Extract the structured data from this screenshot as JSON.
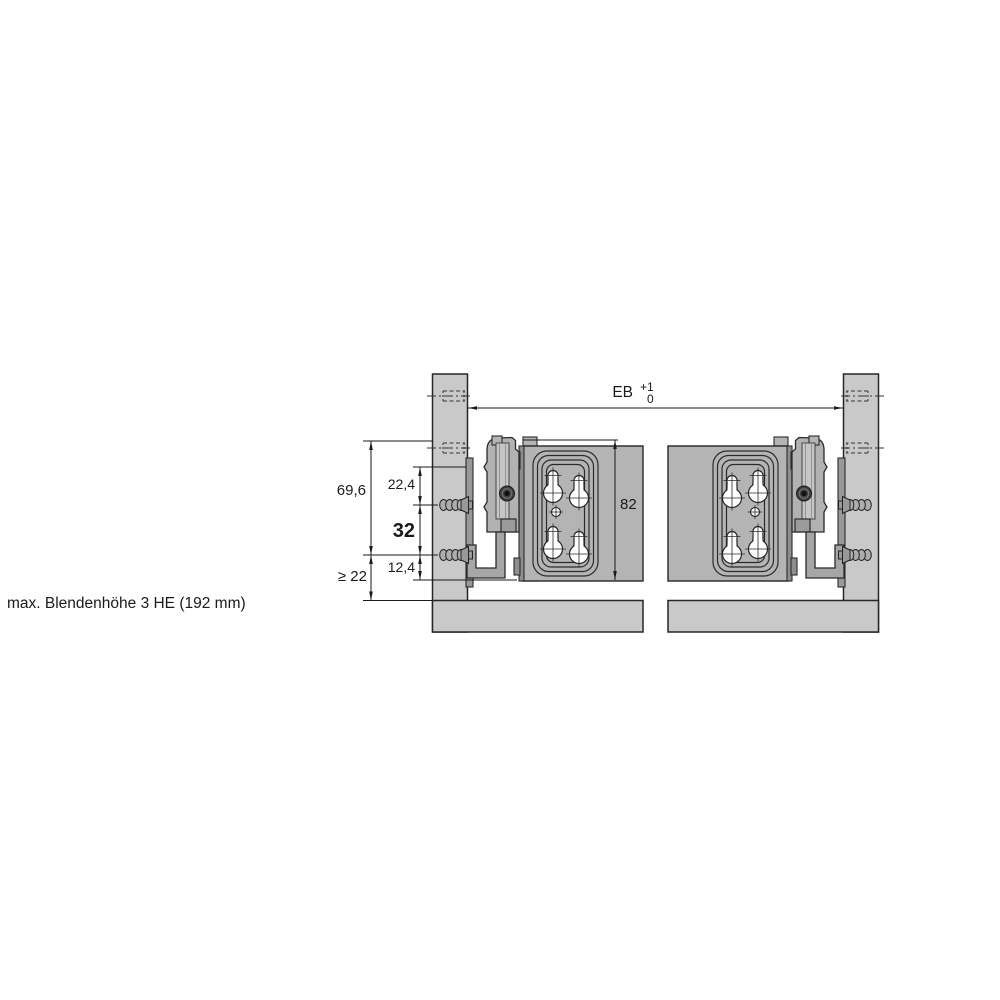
{
  "note": "max. Blendenhöhe 3 HE (192 mm)",
  "dimensions": {
    "installation_width": {
      "label": "EB",
      "tolerance_upper": "+1",
      "tolerance_lower": "0"
    },
    "bracket_total_height": "69,6",
    "top_hole_offset": "22,4",
    "hole_spacing": "32",
    "bottom_hole_offset": "12,4",
    "min_clearance": "≥ 22",
    "plate_height": "82"
  },
  "colors": {
    "background": "#ffffff",
    "side_panel": "#c9c9c9",
    "front_panel": "#b4b4b4",
    "bracket": "#b2b2b2",
    "strap": "#a6a6a6",
    "hardware_dark": "#8e8e8e",
    "line": "#1a1a1a"
  }
}
